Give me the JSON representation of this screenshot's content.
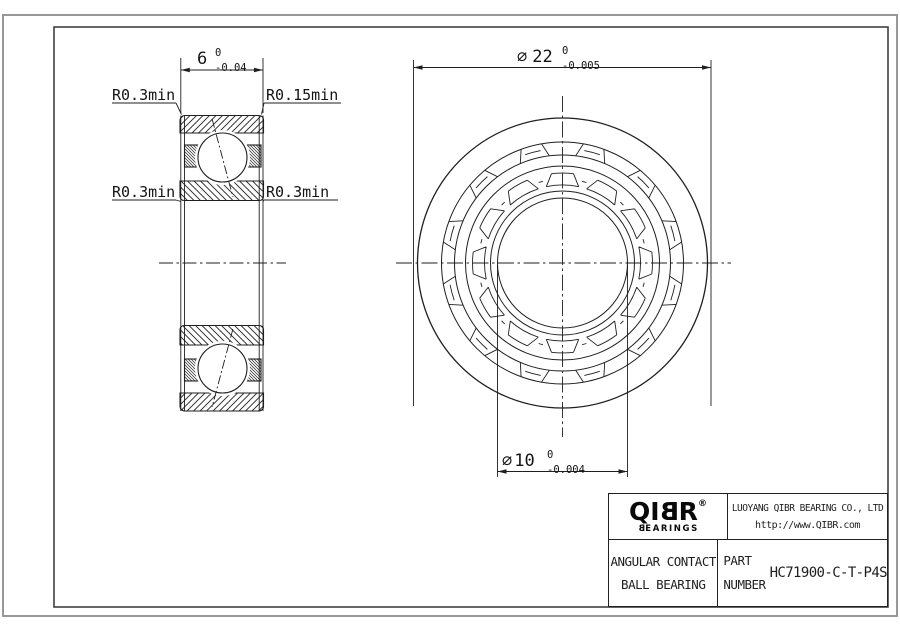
{
  "drawing": {
    "dim_width": {
      "value": "6",
      "upper": "0",
      "lower": "-0.04"
    },
    "dim_od": {
      "symbol": "⌀",
      "value": "22",
      "upper": "0",
      "lower": "-0.005"
    },
    "dim_bore": {
      "symbol": "⌀",
      "value": "10",
      "upper": "0",
      "lower": "-0.004"
    },
    "radius_labels": {
      "top_left": "R0.3min",
      "top_right": "R0.15min",
      "mid_left": "R0.3min",
      "mid_right": "R0.3min"
    }
  },
  "title_block": {
    "logo_text_pre": "QI",
    "logo_text_b": "B",
    "logo_text_post": "R",
    "logo_reg": "®",
    "logo_sub_b": "B",
    "logo_sub_rest": "EARINGS",
    "company": "LUOYANG QIBR BEARING CO., LTD",
    "website": "http://www.QIBR.com",
    "product_line1": "ANGULAR CONTACT",
    "product_line2": "BALL BEARING",
    "part_label1": "PART",
    "part_label2": "NUMBER",
    "part_number": "HC71900-C-T-P4S"
  },
  "colors": {
    "line": "#1f1f1f",
    "frame": "#333333",
    "page_border": "#8c8c8c",
    "background": "#ffffff"
  }
}
